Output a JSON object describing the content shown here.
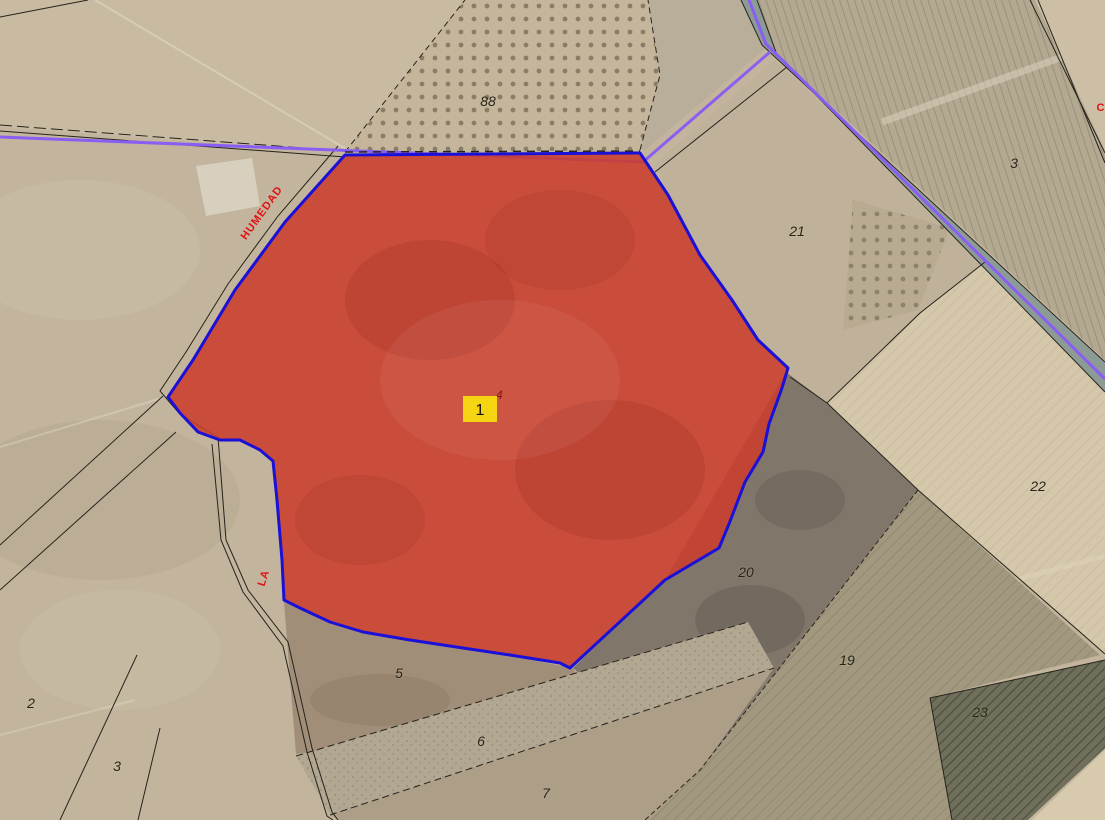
{
  "map": {
    "kind": "aerial-cadastral-parcel-view",
    "route_color": "#8a5ef2",
    "selected_parcel": {
      "marker_label": "1",
      "sub_label": "4",
      "fill_color": "#cb3e2c",
      "border_color": "#1a10d8",
      "marker_bg_color": "#f5d411",
      "sub_label_color": "#8e140b"
    },
    "parcel_numbers": [
      {
        "text": "88",
        "x": 488,
        "y": 101
      },
      {
        "text": "21",
        "x": 797,
        "y": 231
      },
      {
        "text": "3",
        "x": 1014,
        "y": 163
      },
      {
        "text": "22",
        "x": 1038,
        "y": 486
      },
      {
        "text": "20",
        "x": 746,
        "y": 572
      },
      {
        "text": "19",
        "x": 847,
        "y": 660
      },
      {
        "text": "23",
        "x": 980,
        "y": 712
      },
      {
        "text": "5",
        "x": 399,
        "y": 673
      },
      {
        "text": "6",
        "x": 481,
        "y": 741
      },
      {
        "text": "7",
        "x": 546,
        "y": 793
      },
      {
        "text": "2",
        "x": 31,
        "y": 703
      },
      {
        "text": "3",
        "x": 117,
        "y": 766
      }
    ],
    "road_labels": [
      {
        "text": "HUMEDAD",
        "x": 262,
        "y": 213,
        "rotate": -54
      },
      {
        "text": "LA",
        "x": 264,
        "y": 578,
        "rotate": -72
      },
      {
        "text": "C",
        "x": 1101,
        "y": 108,
        "rotate": 0
      }
    ]
  }
}
